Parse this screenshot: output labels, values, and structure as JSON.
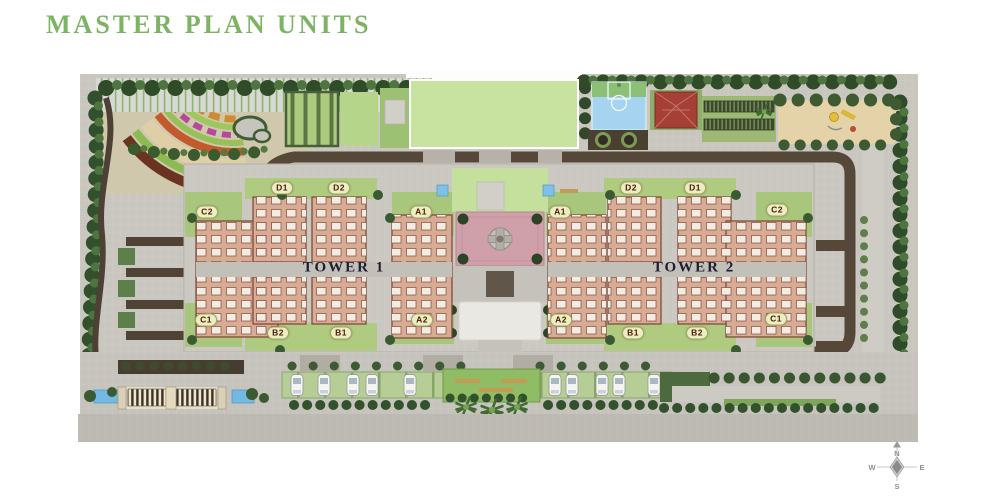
{
  "title": {
    "text": "MASTER PLAN UNITS"
  },
  "plan": {
    "towers": [
      {
        "name": "TOWER 1",
        "units": [
          {
            "label": "C2"
          },
          {
            "label": "D1"
          },
          {
            "label": "D2"
          },
          {
            "label": "A1"
          },
          {
            "label": "C1"
          },
          {
            "label": "B2"
          },
          {
            "label": "B1"
          },
          {
            "label": "A2"
          }
        ]
      },
      {
        "name": "TOWER 2",
        "units": [
          {
            "label": "A1"
          },
          {
            "label": "D2"
          },
          {
            "label": "D1"
          },
          {
            "label": "C2"
          },
          {
            "label": "A2"
          },
          {
            "label": "B1"
          },
          {
            "label": "B2"
          },
          {
            "label": "C1"
          }
        ]
      }
    ],
    "compass": {
      "north": "N",
      "south": "S",
      "east": "E",
      "west": "W"
    },
    "colors": {
      "title_green": "#7cb464",
      "unit_label_bg": "#e9efbe",
      "unit_label_text": "#55160f",
      "tower_text": "#1e1e32",
      "lawn_green": "#c7e39f",
      "court_blue": "#a6d3ef",
      "clubhouse_roof": "#a63f35",
      "road_dark": "#564838",
      "plaza_pink": "#d0a0aa",
      "building_salmon": "#d7ab94",
      "play_sand": "#e4d2a9",
      "water_blue": "#74b9e2"
    }
  }
}
